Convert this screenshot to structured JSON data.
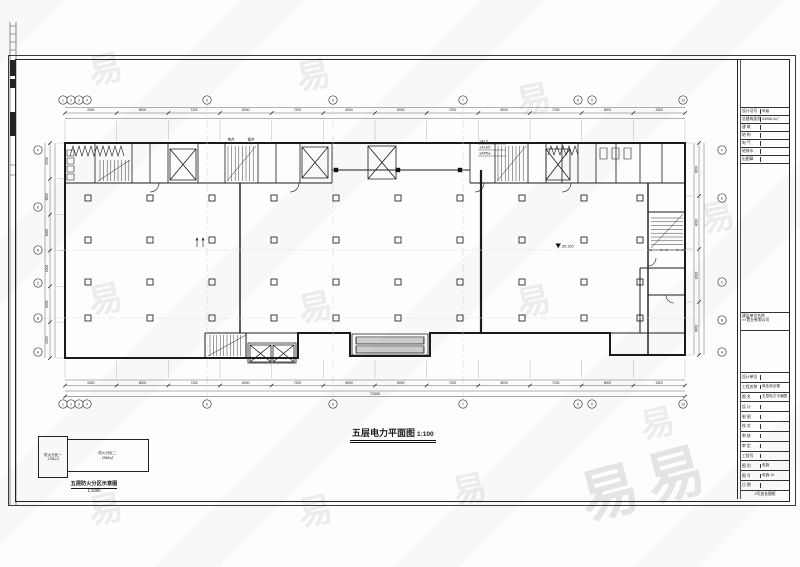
{
  "watermark": {
    "char": "易",
    "big": "易易"
  },
  "drawing": {
    "title": "五层电力平面图",
    "scale": "1:100",
    "axes_top": [
      "1",
      "2",
      "3",
      "4",
      "5",
      "6",
      "7",
      "8",
      "9",
      "10"
    ],
    "axes_left": [
      "F",
      "E",
      "D",
      "C",
      "B",
      "A"
    ],
    "axes_right": [
      "F",
      "E",
      "C",
      "B",
      "A"
    ],
    "dims_top": [
      "3300",
      "8000",
      "7200",
      "8000",
      "7200",
      "8000",
      "8000",
      "7200",
      "8000",
      "7200",
      "8000",
      "3300"
    ],
    "dims_bottom": [
      "3300",
      "8000",
      "7200",
      "8000",
      "7200",
      "8000",
      "8000",
      "7200",
      "8000",
      "7200",
      "8000",
      "3300"
    ],
    "dims_left": [
      "2200",
      "6000",
      "8000",
      "8000",
      "6000",
      "2000"
    ],
    "dims_right": [
      "6600",
      "8000",
      "8000",
      "6600"
    ],
    "total_bottom": "72000",
    "panel_labels": [
      "1AL5",
      "1ALE5",
      "1AP5a"
    ],
    "shaft_labels": [
      "电井",
      "管井"
    ],
    "elevation": "35.150"
  },
  "keyplan": {
    "zone1": "防火分区一",
    "zone1_area": "1750㎡",
    "zone2": "防火分区二",
    "zone2_area": "2565㎡",
    "caption": "五层防火分区示意图",
    "scale": "1:1000"
  },
  "titleblock": {
    "top_rows": [
      {
        "label": "设计证号",
        "value": "甲级"
      },
      {
        "label": "总建筑面积",
        "value": "34956.4㎡"
      },
      {
        "label": "建 筑",
        "value": ""
      },
      {
        "label": "结 构",
        "value": ""
      },
      {
        "label": "电 气",
        "value": ""
      },
      {
        "label": "给排水",
        "value": ""
      },
      {
        "label": "出图章",
        "value": ""
      }
    ],
    "owner_label": "建设单位名称",
    "owner_value": "××置业有限公司",
    "bottom_rows": [
      {
        "label": "设计单位",
        "value": ""
      },
      {
        "label": "工程名称",
        "value": "商业综合楼"
      },
      {
        "label": "图 名",
        "value": "五层电力平面图"
      },
      {
        "label": "设 计",
        "value": ""
      },
      {
        "label": "制 图",
        "value": ""
      },
      {
        "label": "校 对",
        "value": ""
      },
      {
        "label": "审 核",
        "value": ""
      },
      {
        "label": "审 定",
        "value": ""
      },
      {
        "label": "工程号",
        "value": ""
      },
      {
        "label": "图 别",
        "value": "电施"
      },
      {
        "label": "图 号",
        "value": "电施-15"
      },
      {
        "label": "日 期",
        "value": ""
      }
    ],
    "size_note": "2号加长图框"
  }
}
